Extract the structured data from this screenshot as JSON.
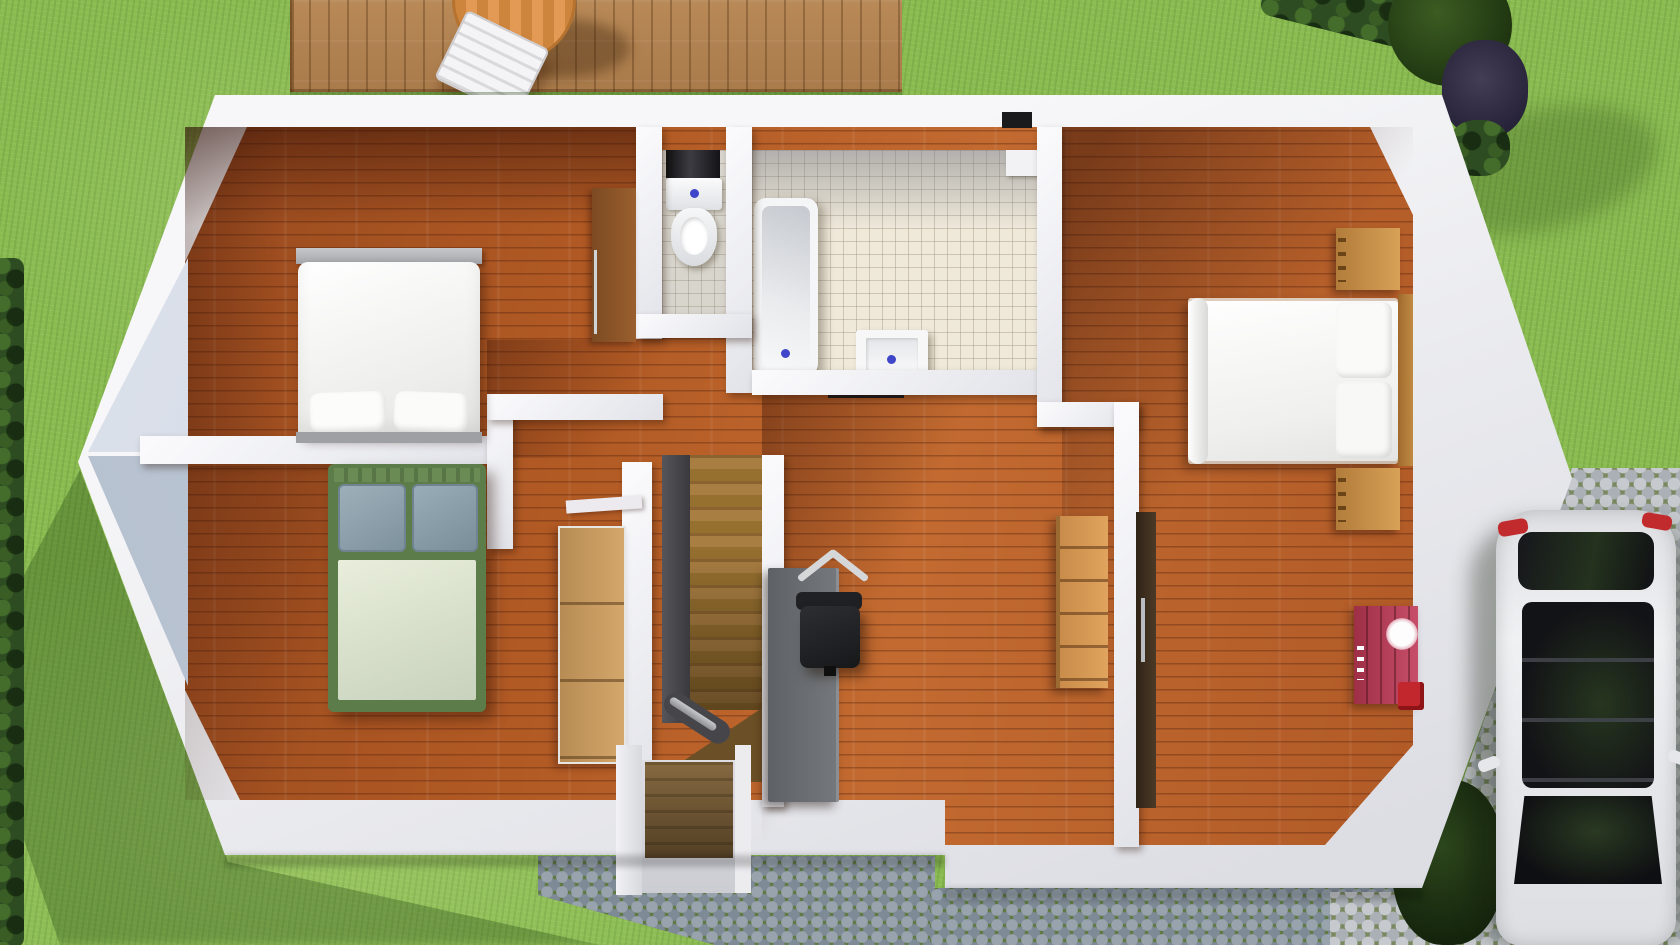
{
  "scene": {
    "type": "floor-plan-3d-render",
    "view": "top-down",
    "setting": "upper floor of a house with garden lawn, wooden deck, cobblestone paths, driveway and parked car",
    "visible_text": "none"
  },
  "palette": {
    "grass": "#8abb51",
    "deck_wood": "#b48354",
    "interior_wood": "#a85525",
    "walls_white": "#f2f1f4",
    "gable_gray": "#c3ccd9",
    "tile_bathroom": "#efe9da",
    "tile_wc": "#d8d5cd",
    "cobblestone": "#98a3ae",
    "driveway_stone": "#c6c9cd",
    "hedge_green": "#2e4c22",
    "bed_frame_green": "#5c7c49",
    "dresser_red": "#b03a55",
    "small_box_red": "#c1272d",
    "stair_banister": "#3c3c40",
    "desk_gray": "#6b6f73",
    "car_body": "#e9eaec",
    "taillight_red": "#c22b2e",
    "drain_blue": "#3f46c9"
  },
  "environment": {
    "areas": [
      {
        "id": "lawn",
        "label": "grass lawn surrounding the house"
      },
      {
        "id": "deck",
        "label": "wooden deck with round table and white lounge chair, top"
      },
      {
        "id": "hedge-left",
        "label": "dark hedge along left edge"
      },
      {
        "id": "hedge-top-right",
        "label": "hedge row and trees, top right"
      },
      {
        "id": "cobble-path",
        "label": "cobblestone path, bottom"
      },
      {
        "id": "driveway",
        "label": "cobblestone driveway, right side"
      }
    ]
  },
  "rooms": [
    {
      "id": "bedroom-top-left",
      "label": "bedroom with white double bed, bench and wardrobe",
      "floor": "wood",
      "furniture": [
        "foot bench",
        "white double bed",
        "two pillows",
        "wardrobe door"
      ]
    },
    {
      "id": "bedroom-bottom-left",
      "label": "bedroom with green framed bed and closet",
      "floor": "wood",
      "furniture": [
        "green framed double bed",
        "two grey pillows",
        "light duvet",
        "wooden closet"
      ]
    },
    {
      "id": "wc",
      "label": "toilet room with tiled floor",
      "floor": "tile",
      "furniture": [
        "toilet with cistern",
        "dark niche"
      ]
    },
    {
      "id": "bathroom",
      "label": "bathroom with bathtub and sink",
      "floor": "tile",
      "furniture": [
        "bathtub",
        "square sink",
        "dark mat",
        "corner shelf"
      ]
    },
    {
      "id": "hall",
      "label": "landing hallway with staircase",
      "floor": "wood",
      "furniture": [
        "staircase with dark banister",
        "stair threshold"
      ]
    },
    {
      "id": "middle-room",
      "label": "middle room with desk and office chair",
      "floor": "wood",
      "furniture": [
        "gray desk",
        "black office chair",
        "wooden shelf unit",
        "dark door"
      ]
    },
    {
      "id": "bedroom-right",
      "label": "bedroom with white bed, nightstands and red dresser",
      "floor": "wood",
      "furniture": [
        "white double bed",
        "two pillows",
        "wooden headboard",
        "upper nightstand",
        "lower nightstand",
        "red dresser with mirror",
        "small red box"
      ]
    }
  ],
  "vehicle": {
    "type": "car",
    "color": "white",
    "orientation": "vertical, rear at top",
    "location": "bottom-right driveway",
    "details": [
      "dark rear window",
      "red taillights",
      "dark panoramic roof",
      "dark windshield",
      "side mirrors"
    ]
  }
}
